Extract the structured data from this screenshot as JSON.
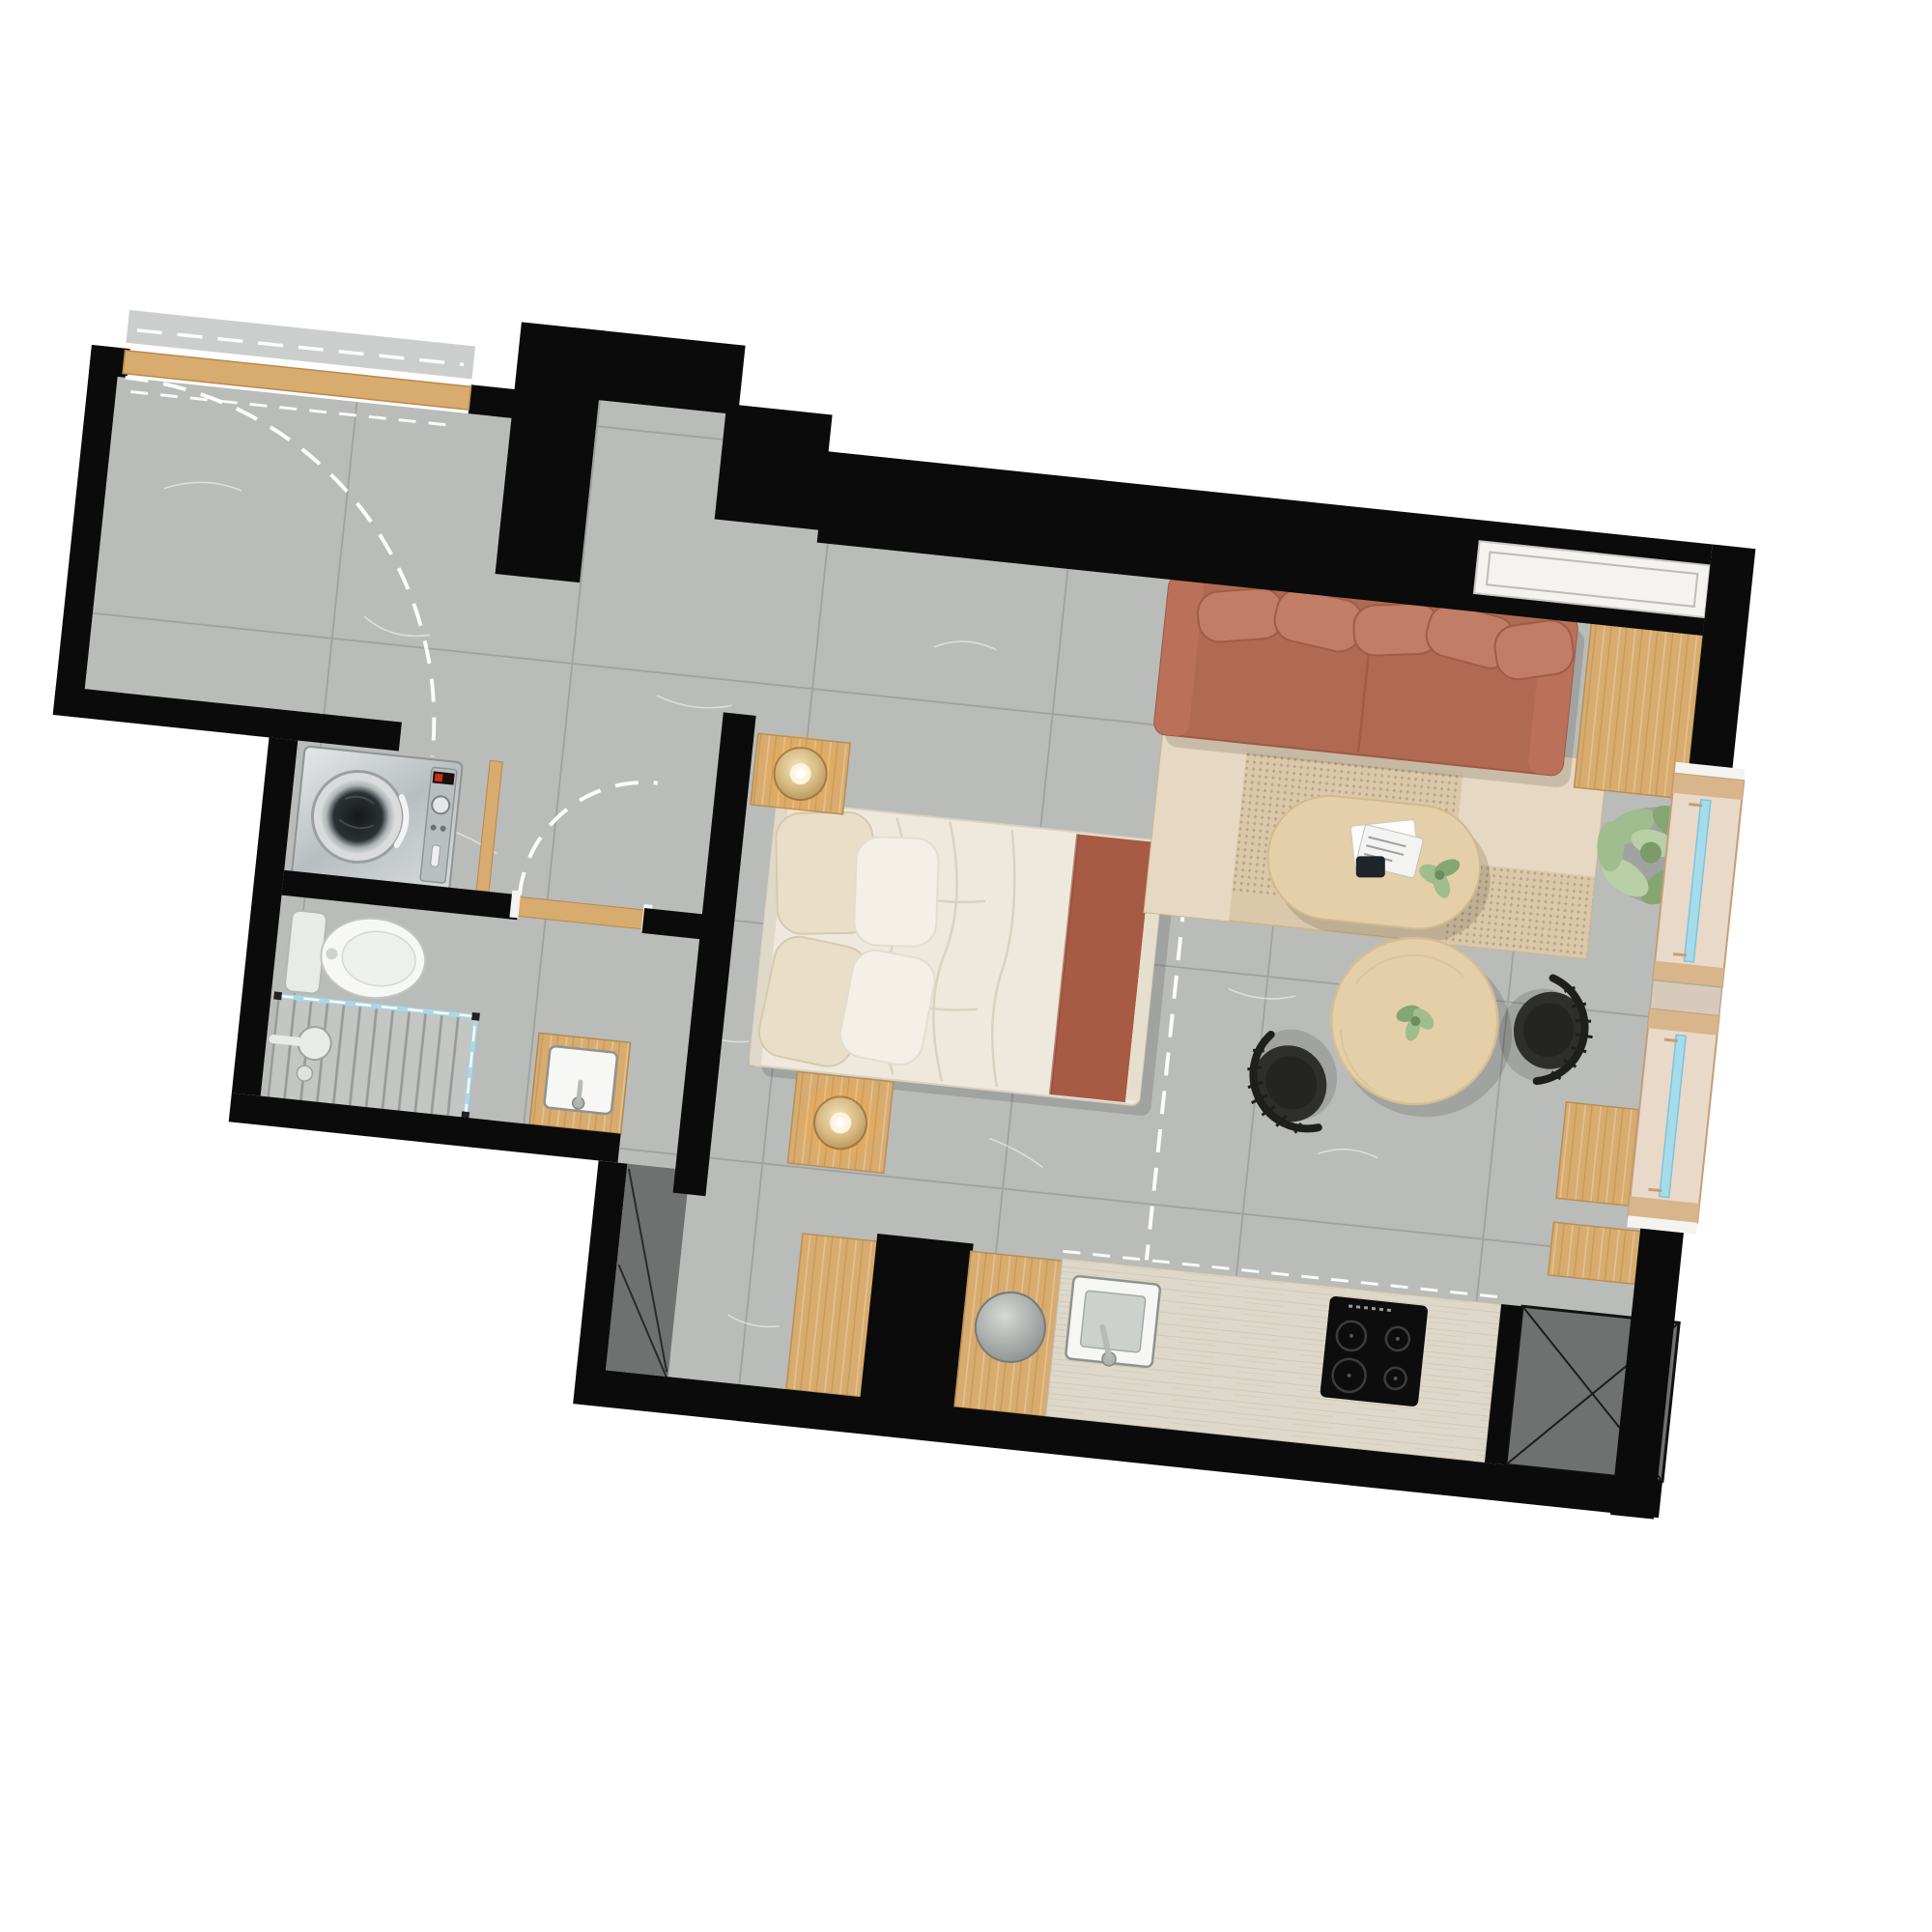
{
  "scene": {
    "type": "apartment-floor-plan",
    "view": "top-down-render",
    "rotation_deg": 6,
    "title": "Studio apartment floor plan"
  },
  "palette": {
    "wall": "#0b0b0b",
    "floor": "#b9bcb9",
    "grout": "#999c9a",
    "wood": "#d8ab6e",
    "wood_light": "#e5cfa8",
    "counter": "#ded8ca",
    "sofa": "#b06a52",
    "sofa_pillow": "#c17d66",
    "bed_linen": "#efe9dd",
    "pillow_cream": "#e9dfc9",
    "blanket": "#a75a44",
    "rug": "#dbc8ab",
    "rug_light": "#e6d8c2",
    "chair": "#2e2e2c",
    "plant": "#9fbd8d",
    "plant_dark": "#85a673",
    "glass": "#a5dcec",
    "shower_glass": "#a9d9e9",
    "lamp_glow": "#ffb54d",
    "appliance": "#c9cdca",
    "dark_zone": "#6e716f",
    "window_frame": "#e9d9c9",
    "window_frame_border": "#c49e78"
  },
  "rooms": [
    {
      "id": "entry-hall",
      "features": [
        "front-door-with-swing-arc",
        "wood-threshold"
      ]
    },
    {
      "id": "hallway",
      "features": [
        "gray-tile-floor"
      ]
    },
    {
      "id": "utility-closet",
      "features": [
        "washing-machine",
        "open-door-leaf"
      ]
    },
    {
      "id": "bathroom",
      "features": [
        "toilet",
        "walk-in-shower",
        "glass-partition",
        "vanity-sink",
        "door-swing-arc"
      ]
    },
    {
      "id": "sleeping-area",
      "features": [
        "double-bed",
        "two-nightstands",
        "two-lamps",
        "headboard-wall",
        "dashed-partition-line"
      ]
    },
    {
      "id": "living-area",
      "features": [
        "sofa",
        "area-rug",
        "oval-coffee-table",
        "magazines",
        "potted-plant",
        "sideboards"
      ]
    },
    {
      "id": "dining-area",
      "features": [
        "round-table",
        "two-black-chairs",
        "table-plant"
      ]
    },
    {
      "id": "kitchen",
      "features": [
        "wood-cabinets",
        "round-basin",
        "square-sink",
        "induction-cooktop-4-burners",
        "service-shaft"
      ]
    }
  ],
  "furniture": {
    "bed": {
      "blanket_color": "#a75a44",
      "pillows": 4
    },
    "sofa": {
      "color": "#b06a52",
      "back_pillows": 5
    },
    "dining_chairs": 2,
    "windows": {
      "right_wall_glazed_units": 2,
      "top_right_corner_window": 1
    },
    "lamps": {
      "count": 2,
      "glow_color": "#ffb54d"
    }
  }
}
